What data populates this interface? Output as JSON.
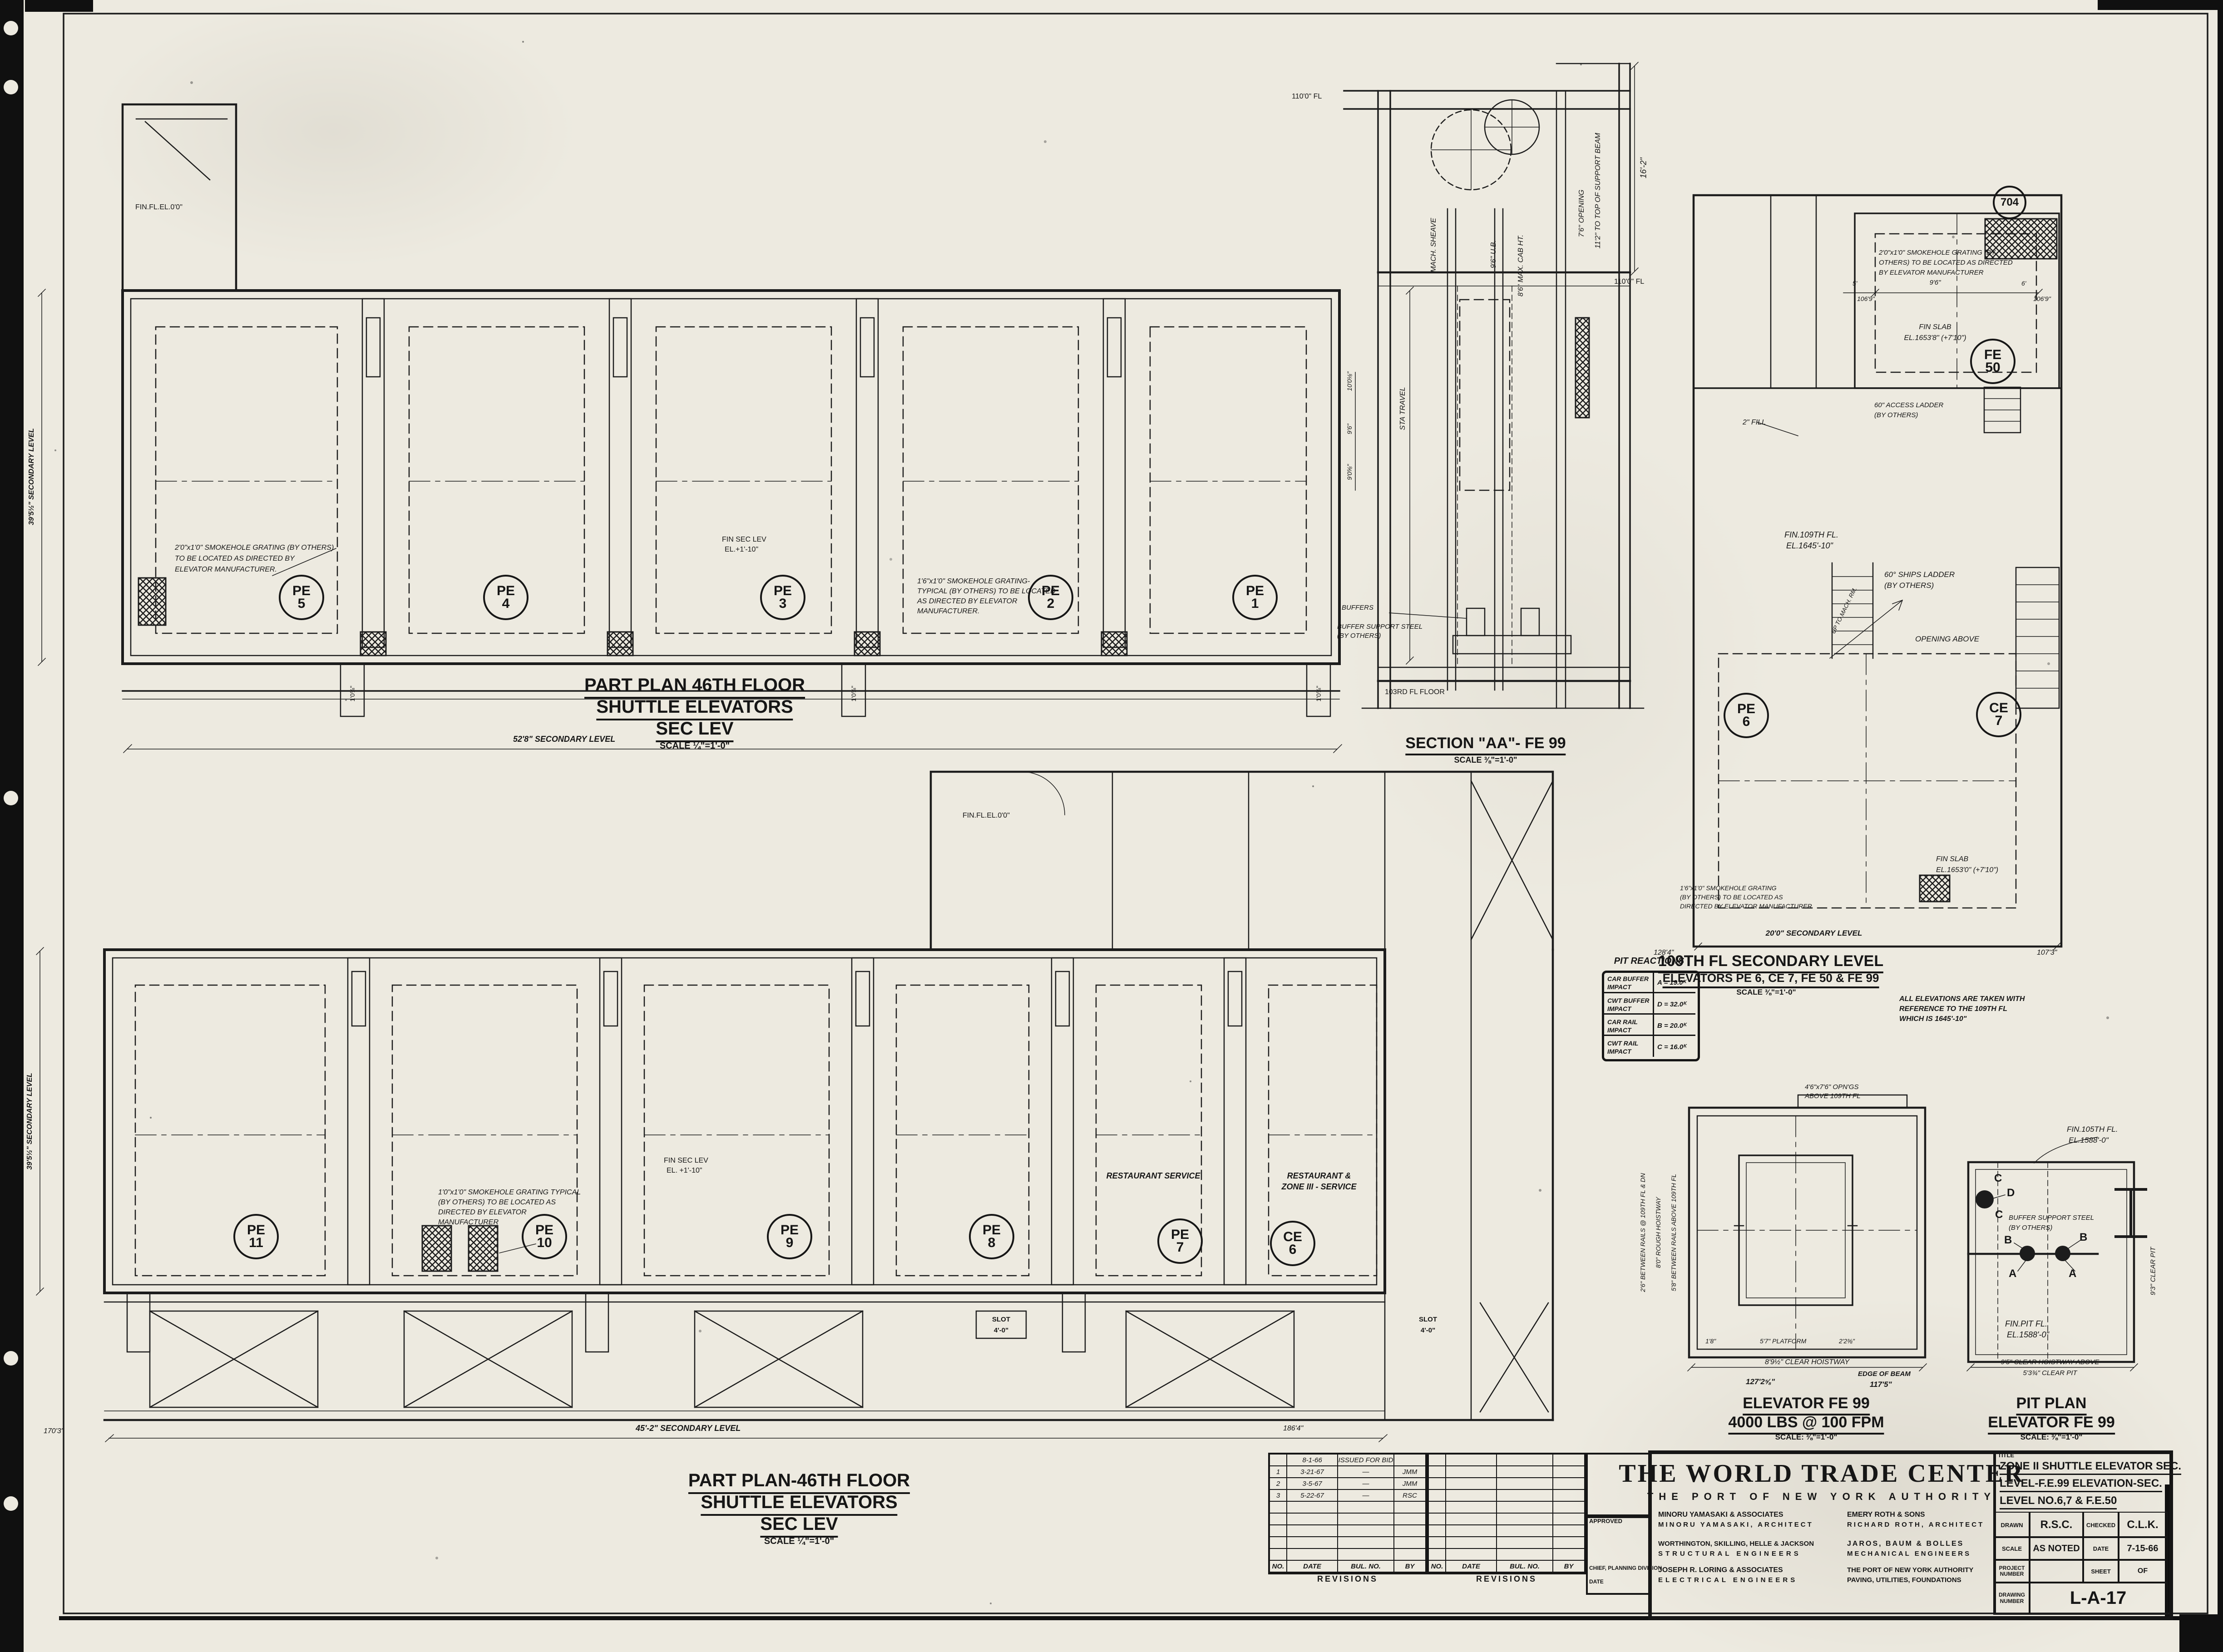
{
  "upper_plan": {
    "title_line1": "PART PLAN 46TH FLOOR",
    "title_line2": "SHUTTLE ELEVATORS",
    "title_line3": "SEC LEV",
    "scale": "SCALE ¼\"=1'-0\"",
    "elevators": [
      {
        "sys": "PE",
        "num": "5"
      },
      {
        "sys": "PE",
        "num": "4"
      },
      {
        "sys": "PE",
        "num": "3"
      },
      {
        "sys": "PE",
        "num": "2"
      },
      {
        "sys": "PE",
        "num": "1"
      }
    ],
    "fin_fl": "FIN.FL.EL.0'0\"",
    "fin_sec_1": "FIN SEC LEV",
    "fin_sec_2": "EL.+1'-10\"",
    "note1_l1": "2'0\"x1'0\" SMOKEHOLE GRATING (BY OTHERS)",
    "note1_l2": "TO BE LOCATED AS DIRECTED BY",
    "note1_l3": "ELEVATOR MANUFACTURER.",
    "note2_l1": "1'6\"x1'0\" SMOKEHOLE GRATING-",
    "note2_l2": "TYPICAL (BY OTHERS) TO BE LOCATED",
    "note2_l3": "AS DIRECTED BY ELEVATOR",
    "note2_l4": "MANUFACTURER.",
    "dim_bottom": "52'8\" SECONDARY LEVEL",
    "dim_left": "39'5½\" SECONDARY LEVEL",
    "door_dim": "1'0⅝\""
  },
  "lower_plan": {
    "title_line1": "PART PLAN-46TH FLOOR",
    "title_line2": "SHUTTLE ELEVATORS",
    "title_line3": "SEC LEV",
    "scale": "SCALE ¼\"=1'-0\"",
    "elevators": [
      {
        "sys": "PE",
        "num": "11"
      },
      {
        "sys": "PE",
        "num": "10"
      },
      {
        "sys": "PE",
        "num": "9"
      },
      {
        "sys": "PE",
        "num": "8"
      },
      {
        "sys": "PE",
        "num": "7"
      },
      {
        "sys": "CE",
        "num": "6"
      }
    ],
    "restaurant_service": "RESTAURANT SERVICE",
    "restaurant_zone_1": "RESTAURANT &",
    "restaurant_zone_2": "ZONE III - SERVICE",
    "note1_l1": "1'0\"x1'0\" SMOKEHOLE GRATING TYPICAL",
    "note1_l2": "(BY OTHERS) TO BE LOCATED AS",
    "note1_l3": "DIRECTED BY ELEVATOR",
    "note1_l4": "MANUFACTURER",
    "fin_sec_1": "FIN SEC LEV",
    "fin_sec_2": "EL. +1'-10\"",
    "fin_fl": "FIN.FL.EL.0'0\"",
    "slot_label": "SLOT",
    "slot_dim": "4'-0\"",
    "dim_bottom": "45'-2\" SECONDARY LEVEL",
    "dim_left": "39'5½\" SECONDARY LEVEL",
    "dim_170": "170'3\"",
    "dim_186": "186'4\""
  },
  "section_aa": {
    "title": "SECTION \"AA\"- FE 99",
    "scale": "SCALE ⅜\"=1'-0\"",
    "mach_sheave": "MACH. SHEAVE",
    "ub": "9'6\" U.B.",
    "cab_ht": "8'6\" MAX. CAB HT.",
    "opening": "7'6\" OPENING",
    "support_beam": "11'2\" TO TOP OF SUPPORT BEAM",
    "dim_16_2": "16'-2\"",
    "fl_110": "110'0\" FL",
    "fl_110_left": "110'0\" FL",
    "sta_travel": "STA TRAVEL",
    "dim_a": "10'0⅛\"",
    "dim_b": "9'6\"",
    "dim_c": "9'0⅝\"",
    "buffers": "BUFFERS",
    "buffer_support_1": "BUFFER SUPPORT STEEL",
    "buffer_support_2": "(BY OTHERS)",
    "fl_103": "103RD FL FLOOR"
  },
  "level_109": {
    "title": "109TH FL SECONDARY LEVEL",
    "subtitle": "ELEVATORS PE 6, CE 7, FE 50 & FE 99",
    "scale": "SCALE ⅜\"=1'-0\"",
    "note_elev_1": "ALL ELEVATIONS ARE TAKEN WITH",
    "note_elev_2": "REFERENCE TO THE 109TH FL",
    "note_elev_3": "WHICH IS 1645'-10\"",
    "smoke1_l1": "2'0\"x1'0\" SMOKEHOLE GRATING (BY",
    "smoke1_l2": "OTHERS) TO BE LOCATED AS DIRECTED",
    "smoke1_l3": "BY ELEVATOR MANUFACTURER",
    "smoke2_l1": "1'6\"x1'0\" SMOKEHOLE GRATING",
    "smoke2_l2": "(BY OTHERS) TO BE LOCATED AS",
    "smoke2_l3": "DIRECTED BY ELEVATOR MANUFACTURER",
    "fin_slab1_1": "FIN SLAB",
    "fin_slab1_2": "EL.1653'8\" (+7'10\")",
    "fin_slab2_1": "FIN SLAB",
    "fin_slab2_2": "EL.1653'0\" (+7'10\")",
    "fe50": {
      "sys": "FE",
      "num": "50"
    },
    "pe6": {
      "sys": "PE",
      "num": "6"
    },
    "ce7": {
      "sys": "CE",
      "num": "7"
    },
    "col_bubble": "704",
    "access_ladder_1": "60\" ACCESS LADDER",
    "access_ladder_2": "(BY OTHERS)",
    "ships_ladder_1": "60° SHIPS LADDER",
    "ships_ladder_2": "(BY OTHERS)",
    "up_to_mach": "UP TO MACH. RM.",
    "opening_above": "OPENING ABOVE",
    "fin_109_1": "FIN.109TH FL.",
    "fin_109_2": "EL.1645'-10\"",
    "fill_note": "2\" FILL",
    "dim_9_6": "9'6\"",
    "dim_5": "5'",
    "dim_6": "6'",
    "dim_106_9_l": "106'9\"",
    "dim_106_9_r": "106'9\"",
    "dim_bottom": "20'0\" SECONDARY LEVEL",
    "dim_128_4": "128'4\"",
    "dim_107_3": "107'3\""
  },
  "pit_reactions": {
    "title": "PIT REACTIONS",
    "rows": [
      {
        "l1": "CAR BUFFER",
        "l2": "IMPACT",
        "v": "A = 19.0ᴷ"
      },
      {
        "l1": "CWT BUFFER",
        "l2": "IMPACT",
        "v": "D = 32.0ᴷ"
      },
      {
        "l1": "CAR RAIL",
        "l2": "IMPACT",
        "v": "B = 20.0ᴷ"
      },
      {
        "l1": "CWT RAIL",
        "l2": "IMPACT",
        "v": "C = 16.0ᴷ"
      }
    ]
  },
  "fe99": {
    "title": "ELEVATOR FE 99",
    "capacity": "4000 LBS @ 100 FPM",
    "scale": "SCALE: ⅜\"=1'-0\"",
    "opng_1": "4'6\"x7'6\" OPN'GS",
    "opng_2": "ABOVE 109TH FL",
    "rails_109": "2'6\" BETWEEN RAILS @ 109TH FL & DN",
    "rough_hoistway": "8'0\" ROUGH HOISTWAY",
    "rails_above": "5'8\" BETWEEN RAILS ABOVE 109TH FL",
    "dim_1_8": "1'8\"",
    "platform": "5'7\" PLATFORM",
    "dim_2_2": "2'2⅜\"",
    "clear_hoistway": "8'9½\" CLEAR HOISTWAY",
    "dim_127": "127'2⅝\"",
    "edge_of_beam": "EDGE OF BEAM",
    "dim_117": "117'5\""
  },
  "pit_plan": {
    "title": "PIT PLAN",
    "subtitle": "ELEVATOR FE 99",
    "scale": "SCALE: ⅜\"=1'-0\"",
    "fin_105_1": "FIN.105TH FL.",
    "fin_105_2": "EL.1588'-0\"",
    "buffer_support_1": "BUFFER SUPPORT STEEL",
    "buffer_support_2": "(BY OTHERS)",
    "fin_pit_1": "FIN.PIT FL.",
    "fin_pit_2": "EL.1588'-0\"",
    "clear_pit_rot": "9'3\" CLEAR PIT",
    "clear_hoistway_above": "9'5\" CLEAR HOISTWAY ABOVE",
    "clear_pit": "5'3¾\" CLEAR PIT",
    "pt_a": "A",
    "pt_b": "B",
    "pt_c": "C",
    "pt_d": "D"
  },
  "revisions": {
    "label": "REVISIONS",
    "headers": {
      "no": "NO.",
      "date": "DATE",
      "bul": "BUL. NO.",
      "by": "BY"
    },
    "rows": [
      {
        "no": "",
        "date": "8-1-66",
        "bul": "ISSUED FOR BID",
        "by": ""
      },
      {
        "no": "1",
        "date": "3-21-67",
        "bul": "—",
        "by": "JMM"
      },
      {
        "no": "2",
        "date": "3-5-67",
        "bul": "—",
        "by": "JMM"
      },
      {
        "no": "3",
        "date": "5-22-67",
        "bul": "—",
        "by": "RSC"
      }
    ],
    "approved": "APPROVED",
    "chief": "CHIEF, PLANNING DIVISION",
    "date_label": "DATE"
  },
  "title_block": {
    "tab_label": "TITLE",
    "project": "THE WORLD TRADE CENTER",
    "owner": "THE PORT OF NEW YORK AUTHORITY",
    "firm1_name": "MINORU YAMASAKI & ASSOCIATES",
    "firm1_role": "MINORU YAMASAKI, ARCHITECT",
    "firm2_name": "EMERY ROTH & SONS",
    "firm2_role": "RICHARD ROTH, ARCHITECT",
    "firm3_name": "WORTHINGTON, SKILLING, HELLE & JACKSON",
    "firm3_role": "STRUCTURAL ENGINEERS",
    "firm4_name": "JAROS, BAUM & BOLLES",
    "firm4_role": "MECHANICAL ENGINEERS",
    "firm5_name": "JOSEPH R. LORING & ASSOCIATES",
    "firm5_role": "ELECTRICAL ENGINEERS",
    "firm6_name": "THE PORT OF NEW YORK AUTHORITY",
    "firm6_role": "PAVING, UTILITIES, FOUNDATIONS",
    "drawing_title_1": "ZONE II SHUTTLE ELEVATOR SEC.",
    "drawing_title_2": "LEVEL-F.E.99 ELEVATION-SEC.",
    "drawing_title_3": "LEVEL NO.6,7 & F.E.50",
    "drawn_label": "DRAWN",
    "drawn": "R.S.C.",
    "checked_label": "CHECKED",
    "checked": "C.L.K.",
    "scale_label": "SCALE",
    "scale": "AS NOTED",
    "date_label": "DATE",
    "date": "7-15-66",
    "project_number_label": "PROJECT NUMBER",
    "sheet_label": "SHEET",
    "sheet_of": "OF",
    "drawing_number_label": "DRAWING NUMBER",
    "drawing_number": "L-A-17"
  }
}
